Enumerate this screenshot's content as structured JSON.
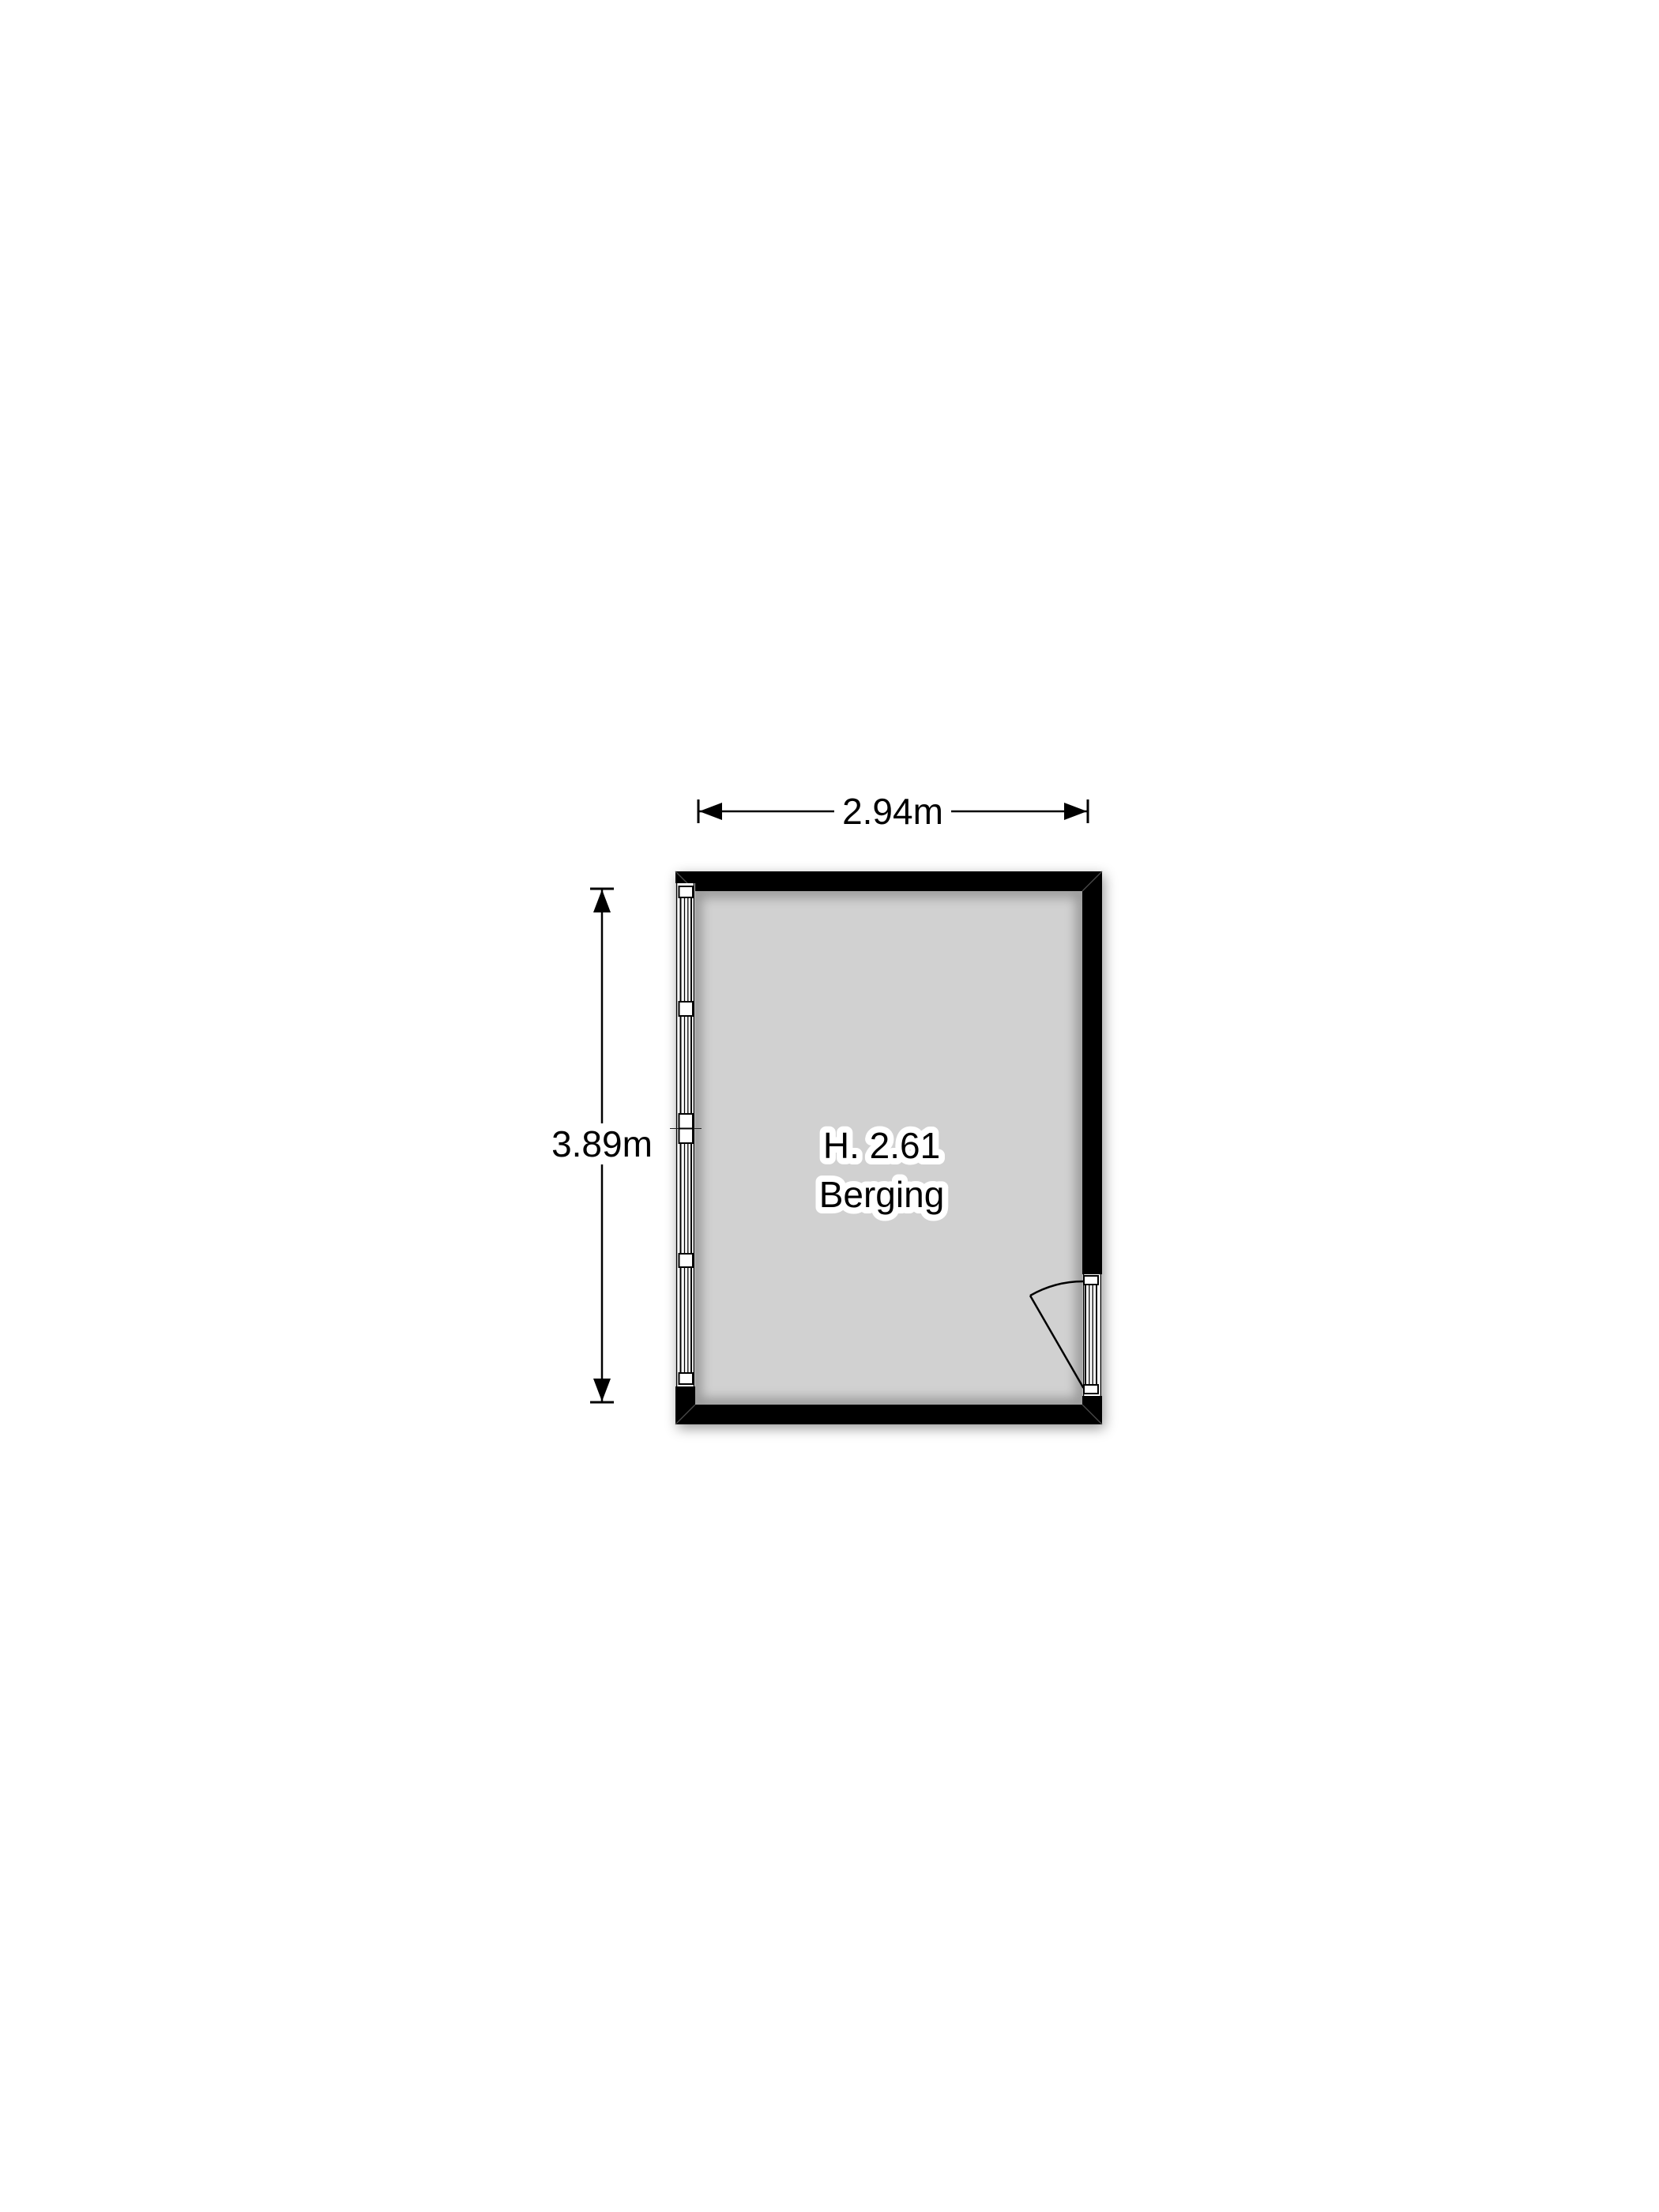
{
  "floorplan": {
    "type": "storage-room-plan",
    "room": {
      "height_label": "H. 2.61",
      "name": "Berging"
    },
    "dimensions": {
      "width_label": "2.94m",
      "depth_label": "3.89m"
    },
    "colors": {
      "wall": "#000000",
      "floor": "#d1d1d1",
      "background": "#ffffff",
      "line": "#000000"
    }
  }
}
